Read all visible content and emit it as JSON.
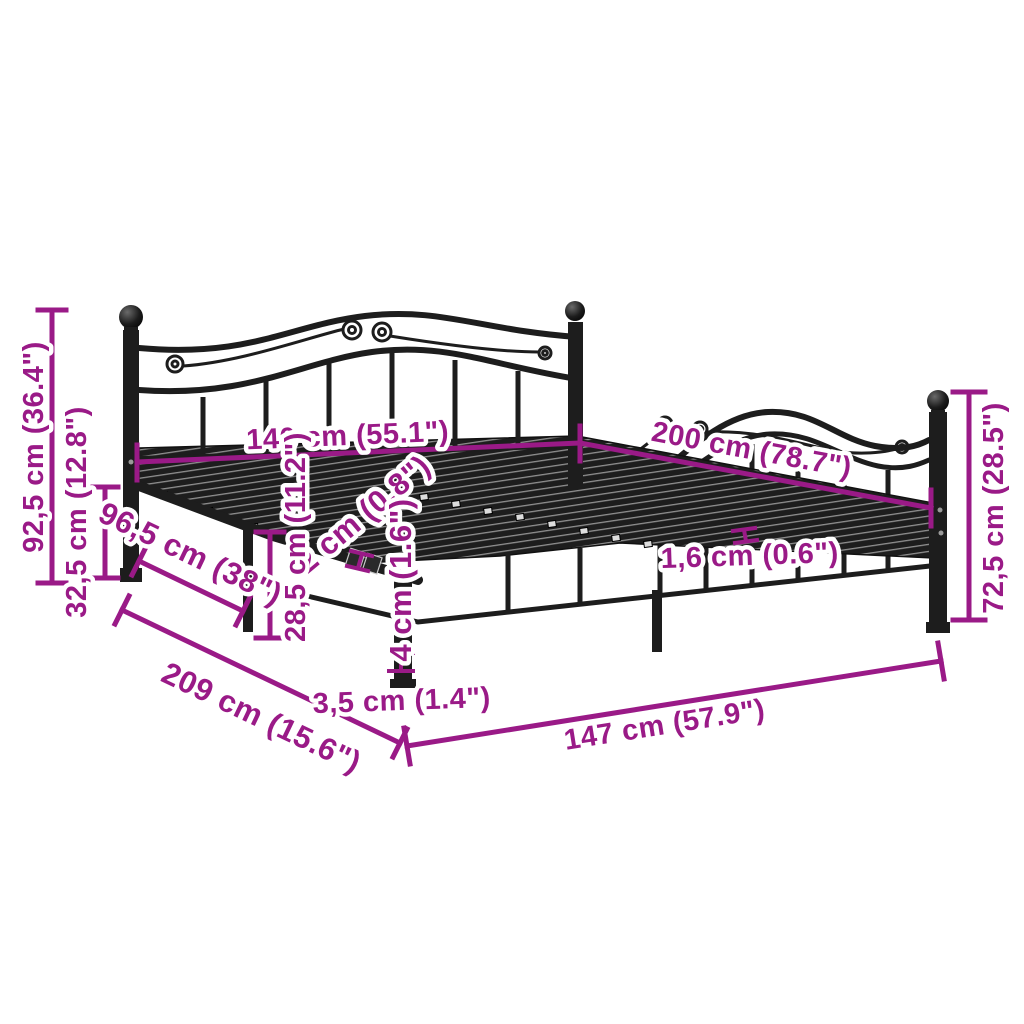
{
  "diagram": {
    "background": "#ffffff",
    "accent_color": "#9A1A87",
    "frame_color": "#1d1d1d",
    "dims": {
      "d92_5": "92,5 cm (36.4\")",
      "d32_5": "32,5 cm (12.8\")",
      "d140": "140 cm (55.1\")",
      "d200": "200 cm (78.7\")",
      "d96_5": "96,5 cm (38\")",
      "d2": "2 cm (0.8\")",
      "d28_5": "28,5 cm (11.2\")",
      "d4": "4 cm (1.6\")",
      "d1_6": "1,6 cm (0.6\")",
      "d72_5": "72,5 cm (28.5\")",
      "d209": "209 cm (15.6\")",
      "d3_5": "3,5 cm (1.4\")",
      "d147": "147 cm (57.9\")"
    }
  }
}
